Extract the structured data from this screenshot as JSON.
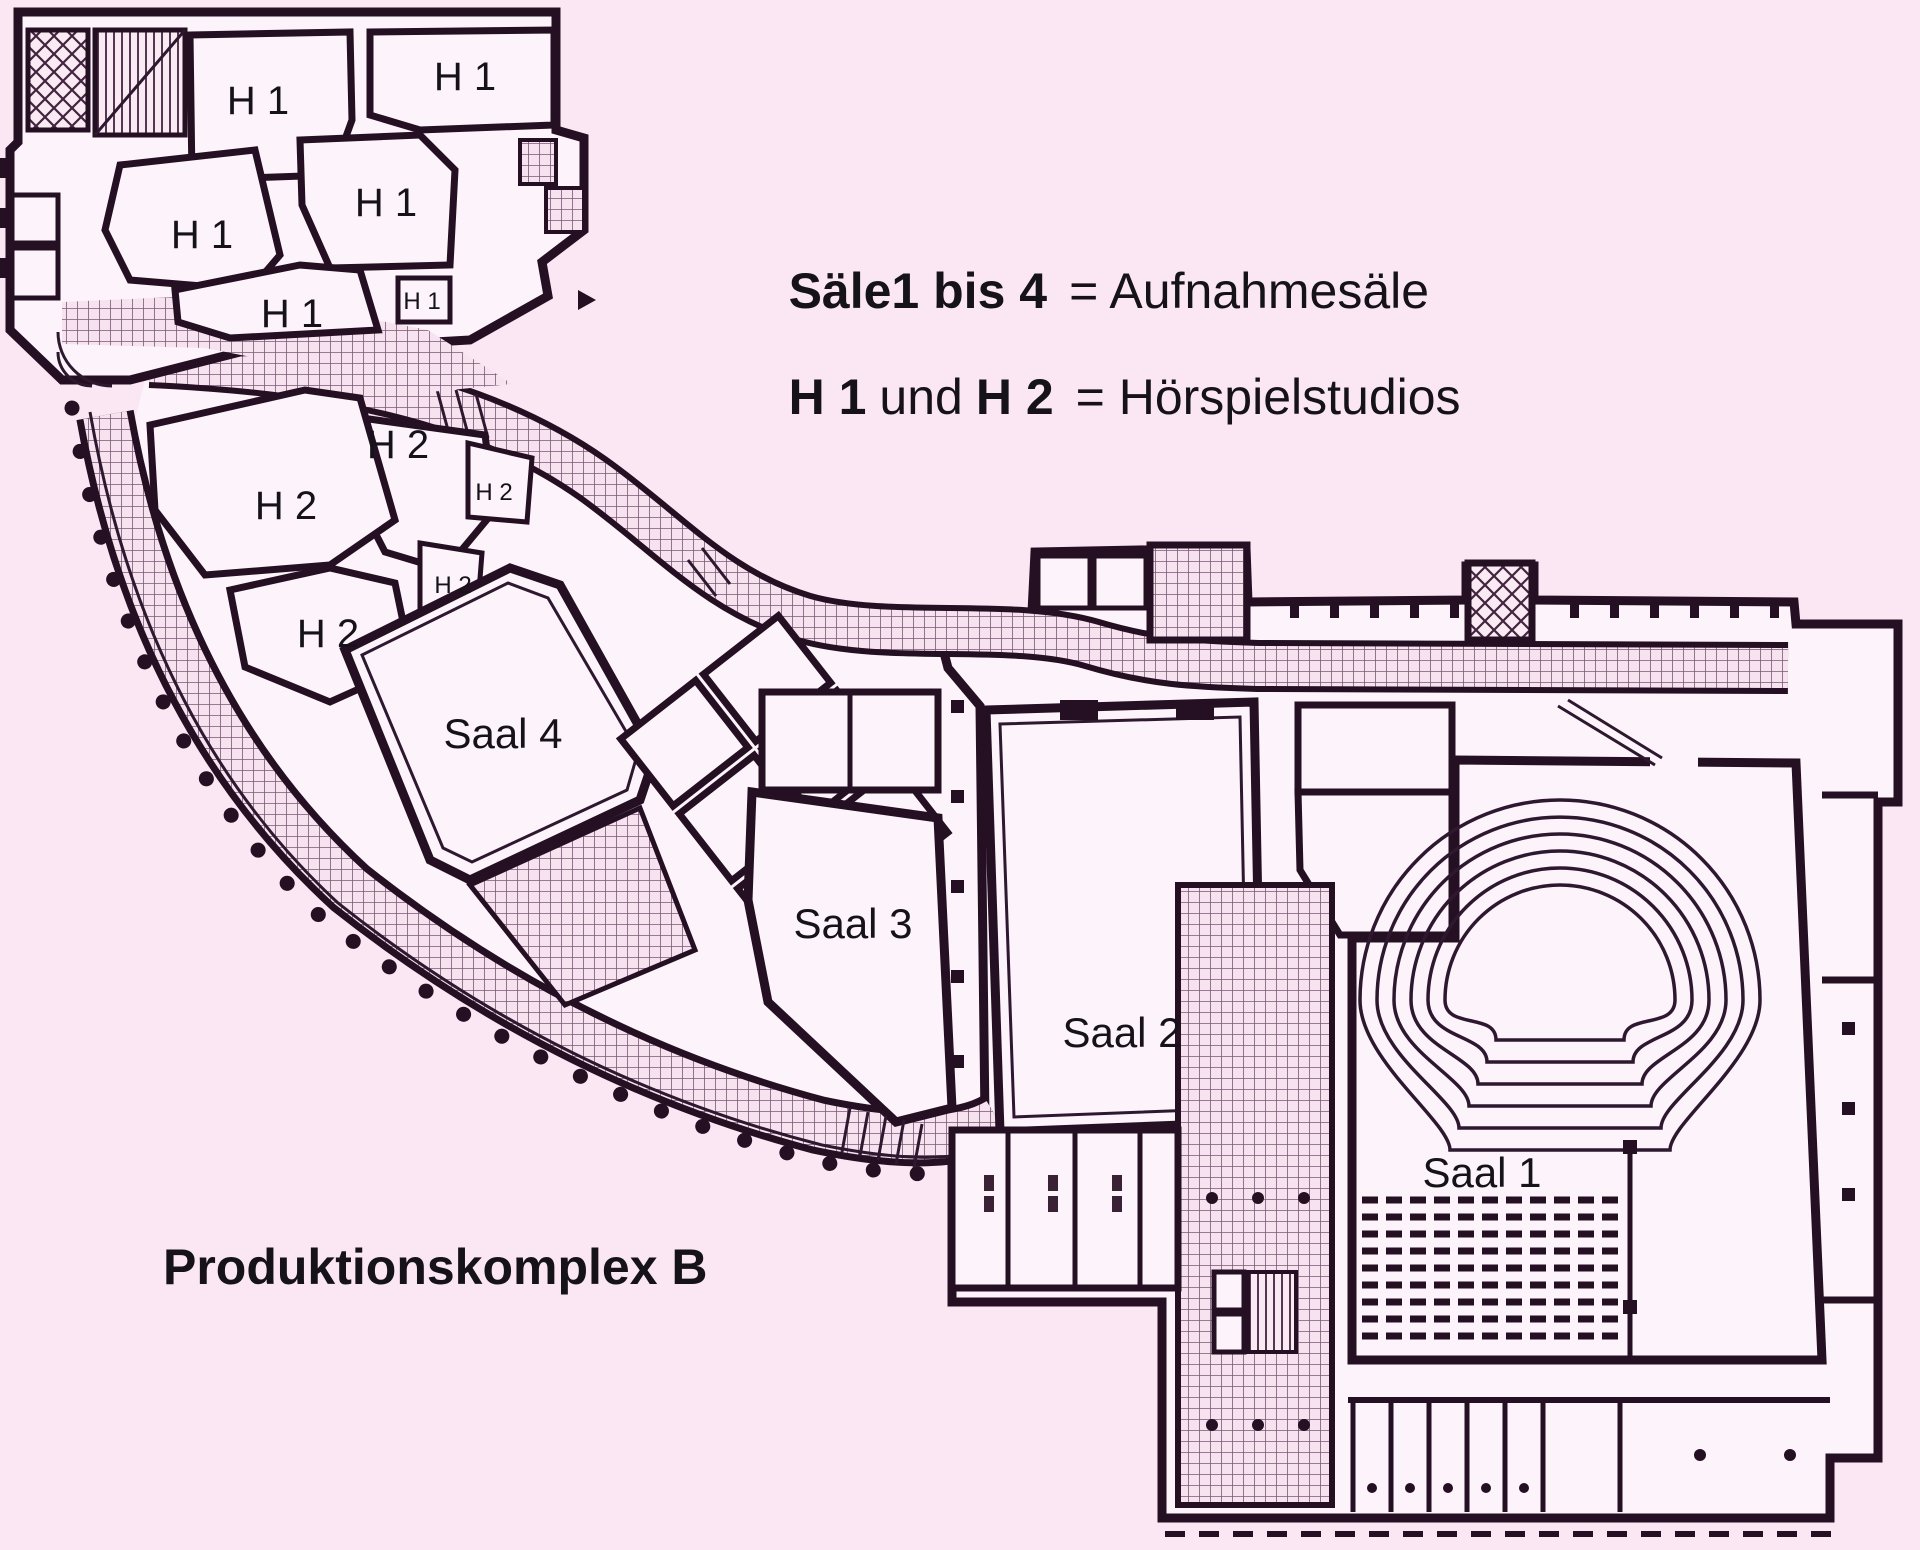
{
  "palette": {
    "background": "#fbe7f4",
    "room_fill": "#fdf3fa",
    "wall": "#241022",
    "hatch": "#7a5874",
    "text": "#15121a"
  },
  "title": {
    "text": "Produktionskomplex B"
  },
  "legend": {
    "line1": {
      "bold": "Säle1 bis 4",
      "rest": "= Aufnahmesäle"
    },
    "line2": {
      "bold1": "H 1",
      "mid": "und",
      "bold2": "H 2",
      "rest": "= Hörspielstudios"
    }
  },
  "rooms": {
    "saal": [
      {
        "label": "Saal 1"
      },
      {
        "label": "Saal 2"
      },
      {
        "label": "Saal 3"
      },
      {
        "label": "Saal 4"
      }
    ],
    "h1": [
      {
        "label": "H 1"
      },
      {
        "label": "H 1"
      },
      {
        "label": "H 1"
      },
      {
        "label": "H 1"
      },
      {
        "label": "H 1"
      },
      {
        "label": "H 1"
      }
    ],
    "h2": [
      {
        "label": "H 2"
      },
      {
        "label": "H 2"
      },
      {
        "label": "H 2"
      },
      {
        "label": "H 2"
      },
      {
        "label": "H 2"
      }
    ]
  }
}
